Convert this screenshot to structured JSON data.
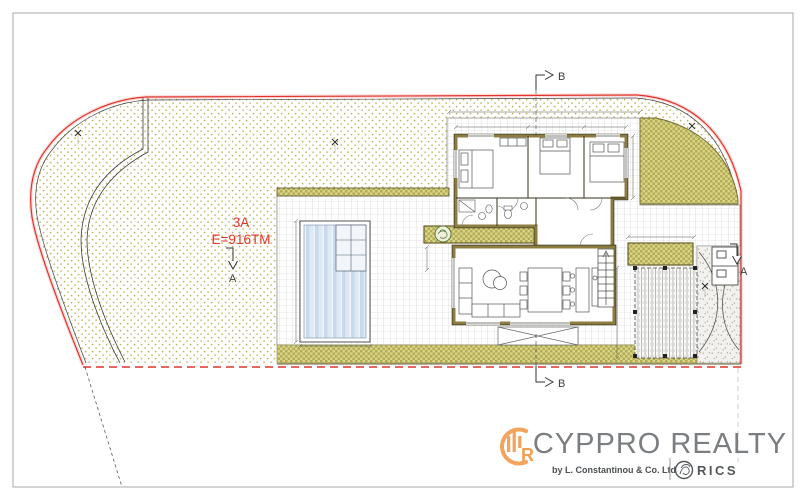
{
  "plot": {
    "label": "3A",
    "area": "E=916TM"
  },
  "sections": {
    "a": "A",
    "b": "B"
  },
  "logo": {
    "brand": "CYPPRO REALTY",
    "byline": "by L. Constantinou & Co. Ltd",
    "rics": "RICS",
    "monogram_letter": "R"
  },
  "colors": {
    "boundary_red": "#e0342c",
    "hatch_dot_olive": "#bfb35f",
    "lawn_checker": "#b2ac55",
    "wall_khaki": "#8d7d40",
    "pool_blue": "#c8daec",
    "logo_orange": "#f2a45c",
    "logo_gray": "#7a7e81",
    "rics_gray": "#54585a"
  }
}
